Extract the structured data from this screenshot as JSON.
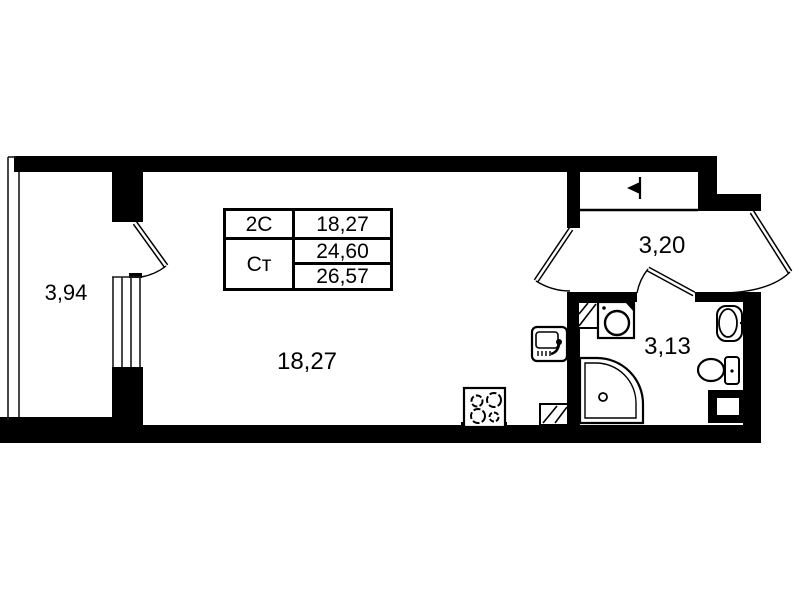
{
  "table": {
    "col1": [
      "2С",
      "Ст"
    ],
    "col2": [
      "18,27",
      "24,60",
      "26,57"
    ]
  },
  "areas": {
    "balcony": "3,94",
    "room": "18,27",
    "hall": "3,20",
    "bathroom": "3,13"
  },
  "colors": {
    "walls": "#000000",
    "background": "#ffffff"
  },
  "fixtures": [
    "stove",
    "kitchen-sink",
    "ventilation-shaft",
    "washing-machine",
    "shower-tray",
    "washbasin",
    "toilet",
    "duct",
    "entry-arrow"
  ]
}
